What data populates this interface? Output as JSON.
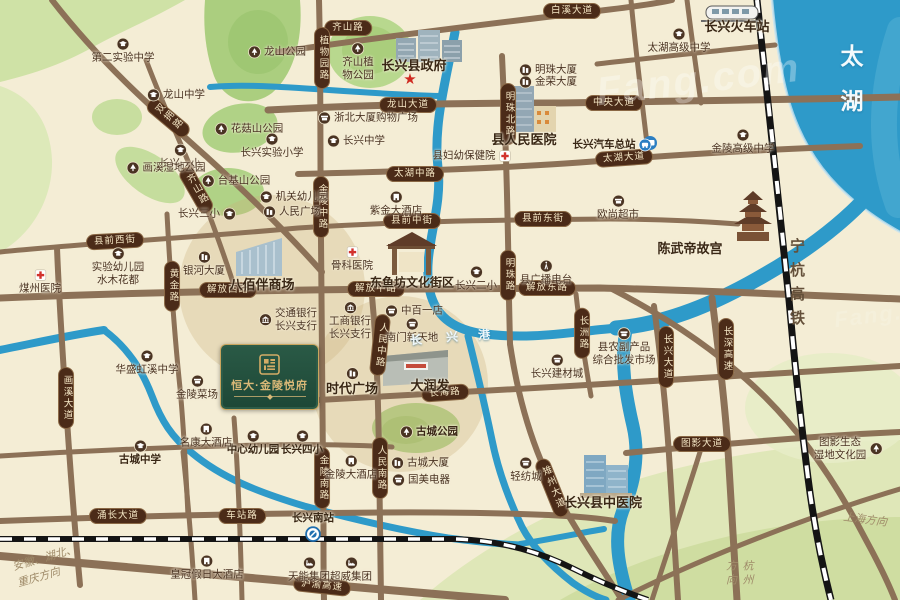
{
  "colors": {
    "cream": "#f4edd5",
    "water": "#2e9ac9",
    "road": "#8c7157",
    "pill": "#4b2b18",
    "green": "#b0d286",
    "gold": "#c9a55e",
    "goldtext": "#d9b877",
    "rail": "#141414"
  },
  "watermark": {
    "text": "Fang.com"
  },
  "lake": {
    "label": "太湖"
  },
  "railway": {
    "label": "宁杭高铁"
  },
  "river": {
    "chars": [
      "长",
      "兴",
      "港"
    ]
  },
  "directions": [
    {
      "lines": [
        "安徽、湖北、",
        "重庆方向"
      ],
      "x": 14,
      "y": 550,
      "rot": -16,
      "v": false
    },
    {
      "lines": [
        "上海方向"
      ],
      "x": 843,
      "y": 512,
      "rot": 7,
      "v": false
    },
    {
      "lines": [
        "杭州方向"
      ],
      "x": 722,
      "y": 560,
      "rot": 0,
      "v": true
    }
  ],
  "logo": {
    "title": "恒大·金陵悦府"
  },
  "government_star": {
    "x": 410,
    "y": 79
  },
  "road_labels": [
    {
      "t": "齐山路",
      "x": 348,
      "y": 28
    },
    {
      "t": "白溪大道",
      "x": 572,
      "y": 11
    },
    {
      "t": "双拥路",
      "x": 168,
      "y": 118,
      "v": true,
      "rot": -50
    },
    {
      "t": "齐山路",
      "x": 196,
      "y": 190,
      "v": true,
      "rot": -30
    },
    {
      "t": "龙山大道",
      "x": 408,
      "y": 105
    },
    {
      "t": "中央大道",
      "x": 614,
      "y": 103
    },
    {
      "t": "植物园路",
      "x": 322,
      "y": 58,
      "v": true
    },
    {
      "t": "明珠北路",
      "x": 508,
      "y": 114,
      "v": true
    },
    {
      "t": "太湖中路",
      "x": 415,
      "y": 174
    },
    {
      "t": "太湖大道",
      "x": 624,
      "y": 158,
      "rot": -4
    },
    {
      "t": "金陵中路",
      "x": 321,
      "y": 207,
      "v": true
    },
    {
      "t": "县前西街",
      "x": 115,
      "y": 241,
      "rot": -3
    },
    {
      "t": "县前中街",
      "x": 412,
      "y": 221
    },
    {
      "t": "县前东街",
      "x": 543,
      "y": 219
    },
    {
      "t": "解放西路",
      "x": 228,
      "y": 290
    },
    {
      "t": "解放中路",
      "x": 376,
      "y": 289
    },
    {
      "t": "解放东路",
      "x": 547,
      "y": 288
    },
    {
      "t": "明珠路",
      "x": 508,
      "y": 275,
      "v": true
    },
    {
      "t": "黄金路",
      "x": 172,
      "y": 286,
      "v": true
    },
    {
      "t": "人民中路",
      "x": 380,
      "y": 345,
      "v": true,
      "rot": 6
    },
    {
      "t": "长洲路",
      "x": 582,
      "y": 333,
      "v": true
    },
    {
      "t": "长兴大道",
      "x": 666,
      "y": 357,
      "v": true
    },
    {
      "t": "长深高速",
      "x": 726,
      "y": 349,
      "v": true
    },
    {
      "t": "长海路",
      "x": 445,
      "y": 393,
      "rot": -4
    },
    {
      "t": "画溪大道",
      "x": 66,
      "y": 398,
      "v": true
    },
    {
      "t": "金陵南路",
      "x": 322,
      "y": 478,
      "v": true
    },
    {
      "t": "人民南路",
      "x": 380,
      "y": 468,
      "v": true
    },
    {
      "t": "雉州大道",
      "x": 552,
      "y": 488,
      "v": true,
      "rot": -22
    },
    {
      "t": "涌长大道",
      "x": 118,
      "y": 516
    },
    {
      "t": "车站路",
      "x": 242,
      "y": 516
    },
    {
      "t": "沪渝高速",
      "x": 322,
      "y": 586,
      "rot": 6
    },
    {
      "t": "图影大道",
      "x": 702,
      "y": 444
    }
  ],
  "pois": [
    {
      "lines": [
        "第二实验中学"
      ],
      "x": 123,
      "y": 51,
      "icon": "school",
      "ip": "above"
    },
    {
      "lines": [
        "龙山公园"
      ],
      "x": 277,
      "y": 52,
      "icon": "park",
      "ip": "left"
    },
    {
      "lines": [
        "龙山中学"
      ],
      "x": 176,
      "y": 95,
      "icon": "school",
      "ip": "left"
    },
    {
      "lines": [
        "花菇山公园"
      ],
      "x": 249,
      "y": 129,
      "icon": "park",
      "ip": "left"
    },
    {
      "lines": [
        "长兴实验小学"
      ],
      "x": 272,
      "y": 146,
      "icon": "school",
      "ip": "above"
    },
    {
      "lines": [
        "长兴中学"
      ],
      "x": 356,
      "y": 141,
      "icon": "school",
      "ip": "left"
    },
    {
      "lines": [
        "浙北大厦购物广场"
      ],
      "x": 368,
      "y": 118,
      "icon": "shop",
      "ip": "left"
    },
    {
      "lines": [
        "齐山植",
        "物公园"
      ],
      "x": 358,
      "y": 62,
      "icon": "park",
      "ip": "above"
    },
    {
      "lines": [
        "长兴县政府"
      ],
      "x": 414,
      "y": 66,
      "bold": true,
      "size": 13
    },
    {
      "lines": [
        "明珠大厦"
      ],
      "x": 548,
      "y": 70,
      "icon": "biz",
      "ip": "left"
    },
    {
      "lines": [
        "金荣大厦"
      ],
      "x": 548,
      "y": 82,
      "icon": "biz",
      "ip": "left"
    },
    {
      "lines": [
        "县人民医院"
      ],
      "x": 524,
      "y": 140,
      "bold": true,
      "size": 13
    },
    {
      "lines": [
        "县妇幼保健院"
      ],
      "x": 472,
      "y": 156,
      "icon": "hospital",
      "ip": "right"
    },
    {
      "lines": [
        "长兴火车站"
      ],
      "x": 737,
      "y": 27,
      "bold": true,
      "size": 13
    },
    {
      "lines": [
        "太湖高级中学"
      ],
      "x": 679,
      "y": 41,
      "icon": "school",
      "ip": "above"
    },
    {
      "lines": [
        "长兴汽车总站"
      ],
      "x": 612,
      "y": 145,
      "bold": true,
      "icon": "bus",
      "ip": "right"
    },
    {
      "lines": [
        "金陵高级中学"
      ],
      "x": 743,
      "y": 142,
      "icon": "school",
      "ip": "above"
    },
    {
      "lines": [
        "欧尚超市"
      ],
      "x": 618,
      "y": 208,
      "icon": "shop",
      "ip": "above"
    },
    {
      "lines": [
        "陈武帝故宫"
      ],
      "x": 690,
      "y": 249,
      "bold": true,
      "size": 13
    },
    {
      "lines": [
        "煤州医院"
      ],
      "x": 40,
      "y": 282,
      "icon": "hospital",
      "ip": "above"
    },
    {
      "lines": [
        "实验幼儿园",
        "水木花都"
      ],
      "x": 118,
      "y": 267,
      "icon": "school",
      "ip": "above"
    },
    {
      "lines": [
        "银河大厦"
      ],
      "x": 204,
      "y": 264,
      "icon": "biz",
      "ip": "above"
    },
    {
      "lines": [
        "长兴三小"
      ],
      "x": 207,
      "y": 214,
      "icon": "school",
      "ip": "right"
    },
    {
      "lines": [
        "长兴一小"
      ],
      "x": 180,
      "y": 157,
      "icon": "school",
      "ip": "above"
    },
    {
      "lines": [
        "画溪湿地公园"
      ],
      "x": 166,
      "y": 168,
      "icon": "park",
      "ip": "left"
    },
    {
      "lines": [
        "台基山公园"
      ],
      "x": 236,
      "y": 181,
      "icon": "park",
      "ip": "left"
    },
    {
      "lines": [
        "机关幼儿园"
      ],
      "x": 294,
      "y": 197,
      "icon": "school",
      "ip": "left"
    },
    {
      "lines": [
        "人民广场"
      ],
      "x": 292,
      "y": 212,
      "icon": "biz",
      "ip": "left"
    },
    {
      "lines": [
        "八佰伴商场"
      ],
      "x": 262,
      "y": 285,
      "bold": true,
      "size": 13
    },
    {
      "lines": [
        "骨科医院"
      ],
      "x": 352,
      "y": 259,
      "icon": "hospital",
      "ip": "above"
    },
    {
      "lines": [
        "紫金大酒店"
      ],
      "x": 396,
      "y": 204,
      "icon": "hotel",
      "ip": "above"
    },
    {
      "lines": [
        "东鱼坊文化街区"
      ],
      "x": 412,
      "y": 283,
      "bold": true,
      "size": 12
    },
    {
      "lines": [
        "长兴二小"
      ],
      "x": 476,
      "y": 279,
      "icon": "school",
      "ip": "above"
    },
    {
      "lines": [
        "县广播电台"
      ],
      "x": 546,
      "y": 273,
      "icon": "radio",
      "ip": "above"
    },
    {
      "lines": [
        "交通银行",
        "长兴支行"
      ],
      "x": 288,
      "y": 320,
      "icon": "bank",
      "ip": "left"
    },
    {
      "lines": [
        "工商银行",
        "长兴支行"
      ],
      "x": 350,
      "y": 321,
      "icon": "bank",
      "ip": "above"
    },
    {
      "lines": [
        "中百一店"
      ],
      "x": 414,
      "y": 311,
      "icon": "shop",
      "ip": "left"
    },
    {
      "lines": [
        "南门新天地"
      ],
      "x": 412,
      "y": 331,
      "icon": "shop",
      "ip": "above"
    },
    {
      "lines": [
        "华盛虹溪中学"
      ],
      "x": 147,
      "y": 363,
      "icon": "school",
      "ip": "above"
    },
    {
      "lines": [
        "金陵菜场"
      ],
      "x": 197,
      "y": 388,
      "icon": "shop",
      "ip": "above"
    },
    {
      "lines": [
        "时代广场"
      ],
      "x": 352,
      "y": 382,
      "bold": true,
      "size": 13,
      "icon": "biz",
      "ip": "above"
    },
    {
      "lines": [
        "大润发"
      ],
      "x": 430,
      "y": 386,
      "bold": true,
      "size": 13
    },
    {
      "lines": [
        "长兴建材城"
      ],
      "x": 557,
      "y": 367,
      "icon": "shop",
      "ip": "above"
    },
    {
      "lines": [
        "县农副产品",
        "综合批发市场"
      ],
      "x": 624,
      "y": 347,
      "icon": "shop",
      "ip": "above"
    },
    {
      "lines": [
        "古城公园"
      ],
      "x": 429,
      "y": 432,
      "bold": true,
      "icon": "park",
      "ip": "left"
    },
    {
      "lines": [
        "中心幼儿园"
      ],
      "x": 253,
      "y": 443,
      "bold": true,
      "icon": "school",
      "ip": "above"
    },
    {
      "lines": [
        "长兴四小"
      ],
      "x": 302,
      "y": 443,
      "bold": true,
      "icon": "school",
      "ip": "above"
    },
    {
      "lines": [
        "名康大酒店"
      ],
      "x": 206,
      "y": 436,
      "icon": "hotel",
      "ip": "above"
    },
    {
      "lines": [
        "古城中学"
      ],
      "x": 140,
      "y": 453,
      "bold": true,
      "icon": "school",
      "ip": "above"
    },
    {
      "lines": [
        "金陵大酒店"
      ],
      "x": 351,
      "y": 468,
      "icon": "hotel",
      "ip": "above"
    },
    {
      "lines": [
        "古城大厦"
      ],
      "x": 420,
      "y": 463,
      "icon": "biz",
      "ip": "left"
    },
    {
      "lines": [
        "国美电器"
      ],
      "x": 421,
      "y": 480,
      "icon": "shop",
      "ip": "left"
    },
    {
      "lines": [
        "轻纺城"
      ],
      "x": 526,
      "y": 470,
      "icon": "shop",
      "ip": "above"
    },
    {
      "lines": [
        "皇冠假日大酒店"
      ],
      "x": 207,
      "y": 568,
      "icon": "hotel",
      "ip": "above"
    },
    {
      "lines": [
        "天能集团"
      ],
      "x": 309,
      "y": 570,
      "icon": "factory",
      "ip": "above"
    },
    {
      "lines": [
        "超威集团"
      ],
      "x": 351,
      "y": 570,
      "icon": "factory",
      "ip": "above"
    },
    {
      "lines": [
        "长兴南站"
      ],
      "x": 313,
      "y": 527,
      "bold": true,
      "icon": "metro",
      "ip": "below"
    },
    {
      "lines": [
        "长兴县中医院"
      ],
      "x": 603,
      "y": 503,
      "bold": true,
      "size": 13
    },
    {
      "lines": [
        "图影生态",
        "湿地文化园"
      ],
      "x": 848,
      "y": 449,
      "icon": "park",
      "ip": "right"
    }
  ]
}
